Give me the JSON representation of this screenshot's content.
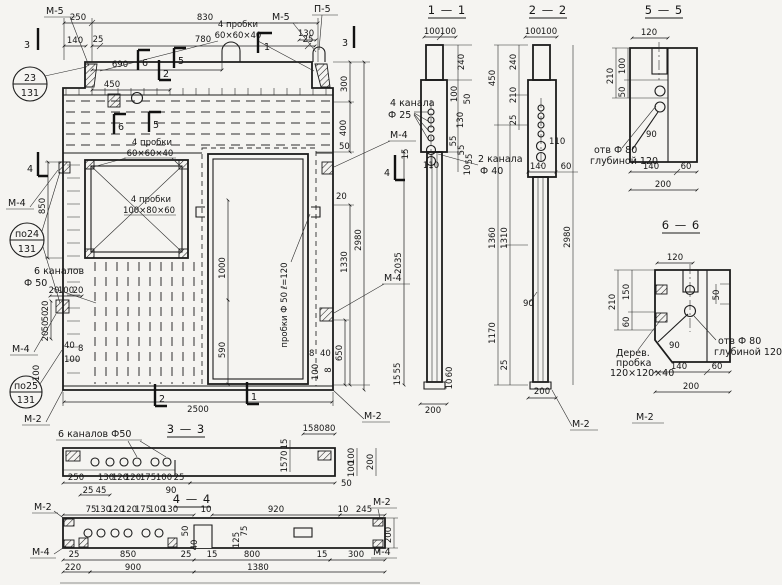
{
  "labels": {
    "m5": "М-5",
    "p5": "П-5",
    "m4": "М-4",
    "m2": "М-2"
  },
  "balloons": {
    "b23": {
      "top": "23",
      "bottom": "131"
    },
    "b24": {
      "top": "по24",
      "bottom": "131"
    },
    "b25": {
      "top": "по25",
      "bottom": "131"
    }
  },
  "cut_marks": {
    "n1": "1",
    "n2": "2",
    "n3": "3",
    "n4": "4",
    "n5": "5",
    "n6": "6"
  },
  "section_titles": {
    "s11": "1 — 1",
    "s22": "2 — 2",
    "s33": "3 — 3",
    "s44": "4 — 4",
    "s55": "5 — 5",
    "s66": "6 — 6"
  },
  "notes": {
    "probki60": [
      "4 пробки",
      "60×60×40"
    ],
    "probki100": [
      "4 пробки",
      "100×80×60"
    ],
    "kanala4": [
      "4 канала",
      "Ф 25"
    ],
    "kanala2": [
      "2 канала",
      "Ф 40"
    ],
    "kanalov6": [
      "6 каналов",
      "Ф 50"
    ],
    "kanalov6_inline": "6 каналов Ф50",
    "probki_f50": "пробки Ф 50  ℓ=120",
    "otv80": [
      "отв Ф 80",
      "глубиной 120"
    ],
    "derev": [
      "Дерев.",
      "пробка",
      "120×120×40"
    ]
  },
  "views": {
    "main": {
      "top": [
        "250",
        "830",
        "140",
        "25",
        "780",
        "25",
        "690",
        "450",
        "130"
      ],
      "right": [
        "300",
        "400",
        "50",
        "20",
        "1330",
        "2980",
        "2035",
        "650"
      ],
      "left": [
        "850",
        "20",
        "100",
        "20",
        "20",
        "50",
        "50",
        "20",
        "40",
        "8",
        "100",
        "100"
      ],
      "door": [
        "1000",
        "590",
        "8",
        "40",
        "100",
        "8"
      ],
      "bottom": [
        "2500"
      ]
    },
    "s11": {
      "head": [
        "100",
        "100"
      ],
      "right": [
        "240",
        "100",
        "50",
        "130",
        "55",
        "55",
        "55",
        "10"
      ],
      "left": [
        "15",
        "110"
      ],
      "bottom": [
        "55",
        "15",
        "60",
        "10",
        "200"
      ]
    },
    "s22": {
      "head": [
        "100",
        "100"
      ],
      "left_outer": [
        "450",
        "1360",
        "1170"
      ],
      "left_inner": [
        "240",
        "210",
        "25",
        "1310",
        "25"
      ],
      "inner": [
        "110",
        "140",
        "60",
        "90"
      ],
      "right": [
        "2980"
      ],
      "bottom": [
        "200"
      ]
    },
    "s33": {
      "row1": [
        "250",
        "130",
        "120",
        "120",
        "175",
        "100",
        "25"
      ],
      "row2": [
        "25",
        "45",
        "90"
      ],
      "right_top": [
        "15",
        "80",
        "80"
      ],
      "right_rot": [
        "15",
        "70",
        "15",
        "100",
        "100",
        "200",
        "50"
      ]
    },
    "s44": {
      "top": [
        "75",
        "130",
        "120",
        "120",
        "175",
        "100",
        "130",
        "10",
        "920",
        "10",
        "245"
      ],
      "mid": [
        "50",
        "40",
        "125",
        "75"
      ],
      "row1": [
        "25",
        "850",
        "25",
        "15",
        "800",
        "15",
        "300"
      ],
      "row2": [
        "220",
        "900",
        "1380"
      ],
      "right": [
        "200"
      ]
    },
    "s55": {
      "head": [
        "120"
      ],
      "left": [
        "210",
        "100",
        "50"
      ],
      "inner": [
        "90"
      ],
      "bottom": [
        "140",
        "60",
        "200"
      ]
    },
    "s66": {
      "head": [
        "120"
      ],
      "left": [
        "210",
        "150",
        "60"
      ],
      "right": [
        "50"
      ],
      "inner": [
        "90"
      ],
      "bottom": [
        "140",
        "60",
        "200"
      ]
    }
  }
}
